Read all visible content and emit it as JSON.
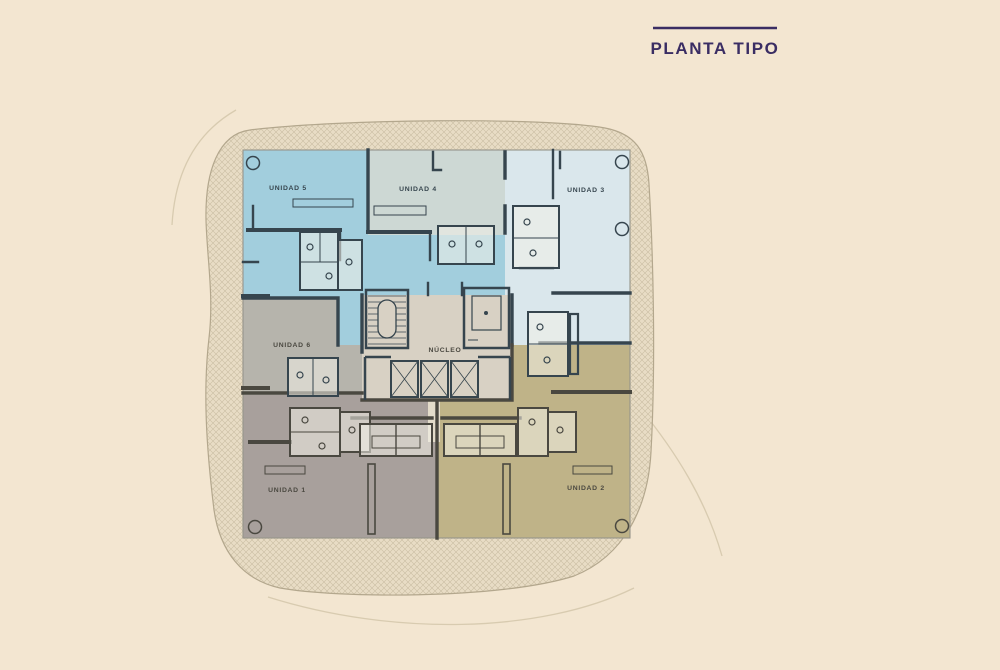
{
  "header": {
    "title": "PLANTA TIPO"
  },
  "colors": {
    "background": "#f3e6d1",
    "title_text": "#3a2d63",
    "title_rule": "#3a2d63",
    "site_hatch_base": "#e8dcc5",
    "site_hatch_line": "#cabda3",
    "site_outline": "#b3a78d",
    "decorative_line": "#d8cbb0",
    "slab_base": "#d8d1c4",
    "slab_edge": "#96948a",
    "wall_top": "#36454e",
    "wall_bottom": "#4a4840",
    "core_fill": "#d8d1c4",
    "corridor_fill": "#e3dcca"
  },
  "floorplan": {
    "core_label": "NÚCLEO",
    "units": [
      {
        "id": "unidad-5",
        "label": "UNIDAD 5",
        "color": "#a2cedd",
        "position": "top-left"
      },
      {
        "id": "unidad-4",
        "label": "UNIDAD 4",
        "color": "#cdd8d4",
        "position": "top-center"
      },
      {
        "id": "unidad-3",
        "label": "UNIDAD 3",
        "color": "#dae7ec",
        "position": "top-right"
      },
      {
        "id": "unidad-6",
        "label": "UNIDAD 6",
        "color": "#b6b4ac",
        "position": "middle-left"
      },
      {
        "id": "unidad-1",
        "label": "UNIDAD 1",
        "color": "#a8a09c",
        "position": "bottom-left"
      },
      {
        "id": "unidad-2",
        "label": "UNIDAD 2",
        "color": "#bfb388",
        "position": "bottom-right"
      }
    ]
  }
}
